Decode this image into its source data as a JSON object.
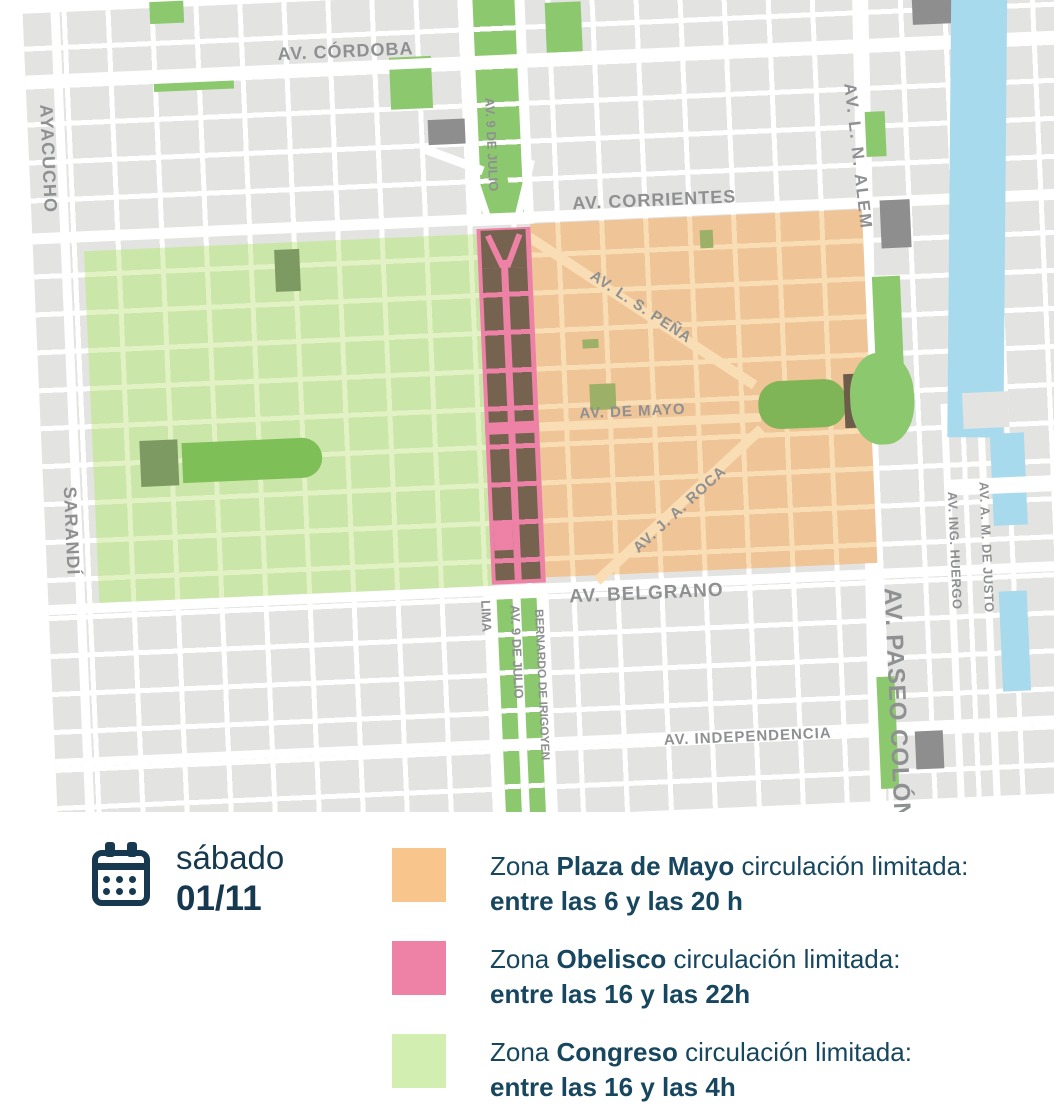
{
  "colors": {
    "zone_plaza": "#F8C68C",
    "zone_obelisco": "#EE82A6",
    "zone_congreso": "#D2EEB0",
    "water": "#A6DAEC",
    "park": "#8CC96E",
    "navy": "#16394F",
    "text_navy": "#17465F",
    "label_gray": "#8F9091",
    "brown": "#756350",
    "olive": "#7D9A62"
  },
  "map": {
    "streets": [
      {
        "name": "AV. CÓRDOBA"
      },
      {
        "name": "AYACUCHO"
      },
      {
        "name": "AV. 9 DE JULIO"
      },
      {
        "name": "AV. CORRIENTES"
      },
      {
        "name": "AV. L. N. ALEM"
      },
      {
        "name": "AV. L. S. PEÑA"
      },
      {
        "name": "AV. DE MAYO"
      },
      {
        "name": "AV. J. A. ROCA"
      },
      {
        "name": "AV. BELGRANO"
      },
      {
        "name": "SARANDÍ"
      },
      {
        "name": "LIMA"
      },
      {
        "name": "AV. 9 DE JULIO"
      },
      {
        "name": "BERNARDO DE IRIGOYEN"
      },
      {
        "name": "AV. INDEPENDENCIA"
      },
      {
        "name": "AV. PASEO COLÓN"
      },
      {
        "name": "AV. ING. HUERGO"
      },
      {
        "name": "AV. A. M. DE JUSTO"
      }
    ]
  },
  "legend": {
    "date": {
      "day": "sábado",
      "date": "01/11"
    },
    "rows": [
      {
        "prefix": "Zona ",
        "zone": "Plaza de Mayo",
        "suffix": " circulación limitada:",
        "hours": "entre las 6 y las 20 h"
      },
      {
        "prefix": "Zona ",
        "zone": "Obelisco",
        "suffix": " circulación limitada:",
        "hours": "entre las 16 y las 22h"
      },
      {
        "prefix": "Zona ",
        "zone": "Congreso",
        "suffix": " circulación limitada:",
        "hours": "entre las 16 y las 4h"
      }
    ]
  }
}
